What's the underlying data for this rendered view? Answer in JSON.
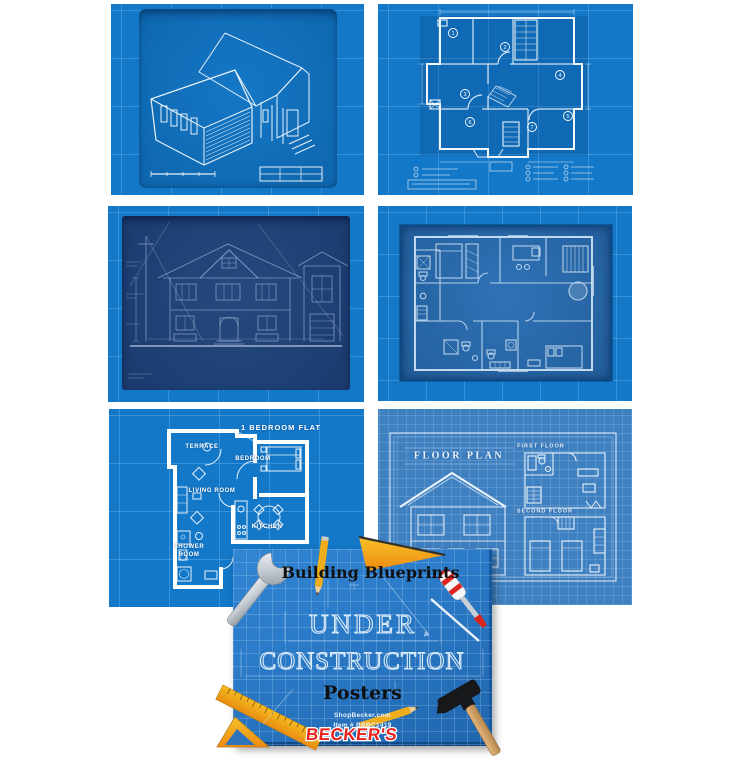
{
  "product": {
    "name": "Building Blueprints Under Construction Posters",
    "poster_count": 6
  },
  "posters": {
    "isometric_house": {
      "description": "isometric blueprint of house exterior"
    },
    "floor_plan_numbered": {
      "description": "floor plan blueprint with numbered rooms",
      "room_numbers": [
        "1",
        "2",
        "3",
        "4",
        "5",
        "6",
        "7"
      ]
    },
    "house_elevation": {
      "description": "dark blueprint of two-story house front elevation"
    },
    "apartment_plan": {
      "description": "furnished apartment floor plan blueprint"
    },
    "one_bedroom_flat": {
      "title": "1 BEDROOM FLAT",
      "rooms": {
        "terrace": "TERRACE",
        "bedroom": "BEDROOM",
        "living_room": "LIVING ROOM",
        "kitchen": "KITCHEN",
        "shower_room": "SHOWER ROOM"
      }
    },
    "floor_plan_elevation": {
      "title": "FLOOR PLAN",
      "first_floor": "FIRST FLOOR",
      "second_floor": "SECOND FLOOR"
    }
  },
  "cover": {
    "heading": "Building Blueprints",
    "title_line1": "UNDER",
    "title_line2": "CONSTRUCTION",
    "subtitle": "Posters",
    "website": "ShopBecker.com",
    "item_number": "Item # BBBC1419",
    "brand": "BECKER'S"
  },
  "colors": {
    "poster_bright_blue": "#1478c8",
    "poster_muted_blue": "#3f80c1",
    "panel_dark_navy": "#1d4076",
    "panel_medium_blue": "#2b6db1",
    "cover_blue": "#2779c7",
    "line_white": "#ffffff",
    "brand_red": "#e8211d",
    "tool_yellow": "#f5b31c",
    "tool_orange": "#ef9415",
    "wood_handle": "#d9a96c",
    "steel_gray": "#c9d0d6"
  }
}
